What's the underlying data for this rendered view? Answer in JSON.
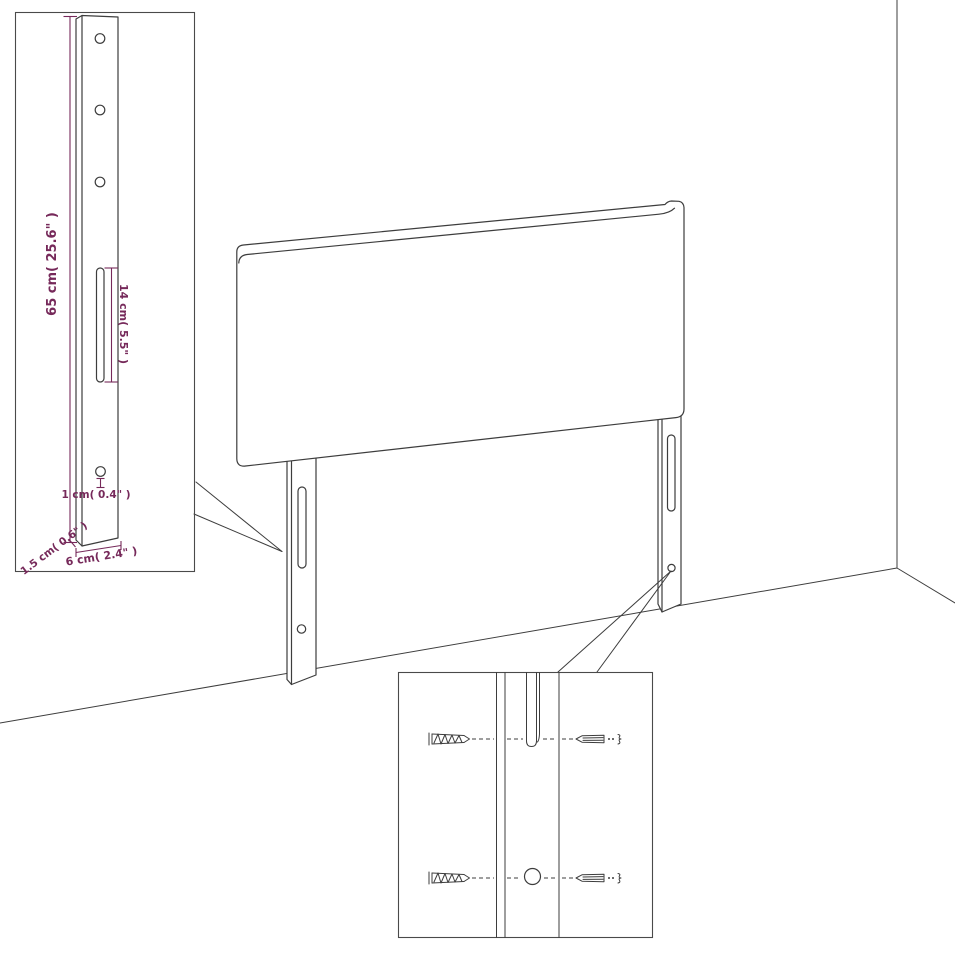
{
  "diagram": {
    "kind": "furniture dimension / wall-mount instruction drawing",
    "subject": "upholstered headboard with two mounting legs"
  },
  "dimension_labels": {
    "height": "65 cm( 25.6\" )",
    "slot_height": "14 cm( 5.5\" )",
    "hole_diameter": "1 cm( 0.4\" )",
    "thickness": "1.5 cm( 0.6\" )",
    "leg_width": "6 cm( 2.4\" )"
  },
  "icons": {
    "screw": "screw-icon",
    "wall_plug": "wall-plug-icon"
  },
  "colors": {
    "dimension_text": "#76295a",
    "line_art": "#3d3d3d",
    "inset_border": "#4a4a4a",
    "background": "#ffffff"
  }
}
